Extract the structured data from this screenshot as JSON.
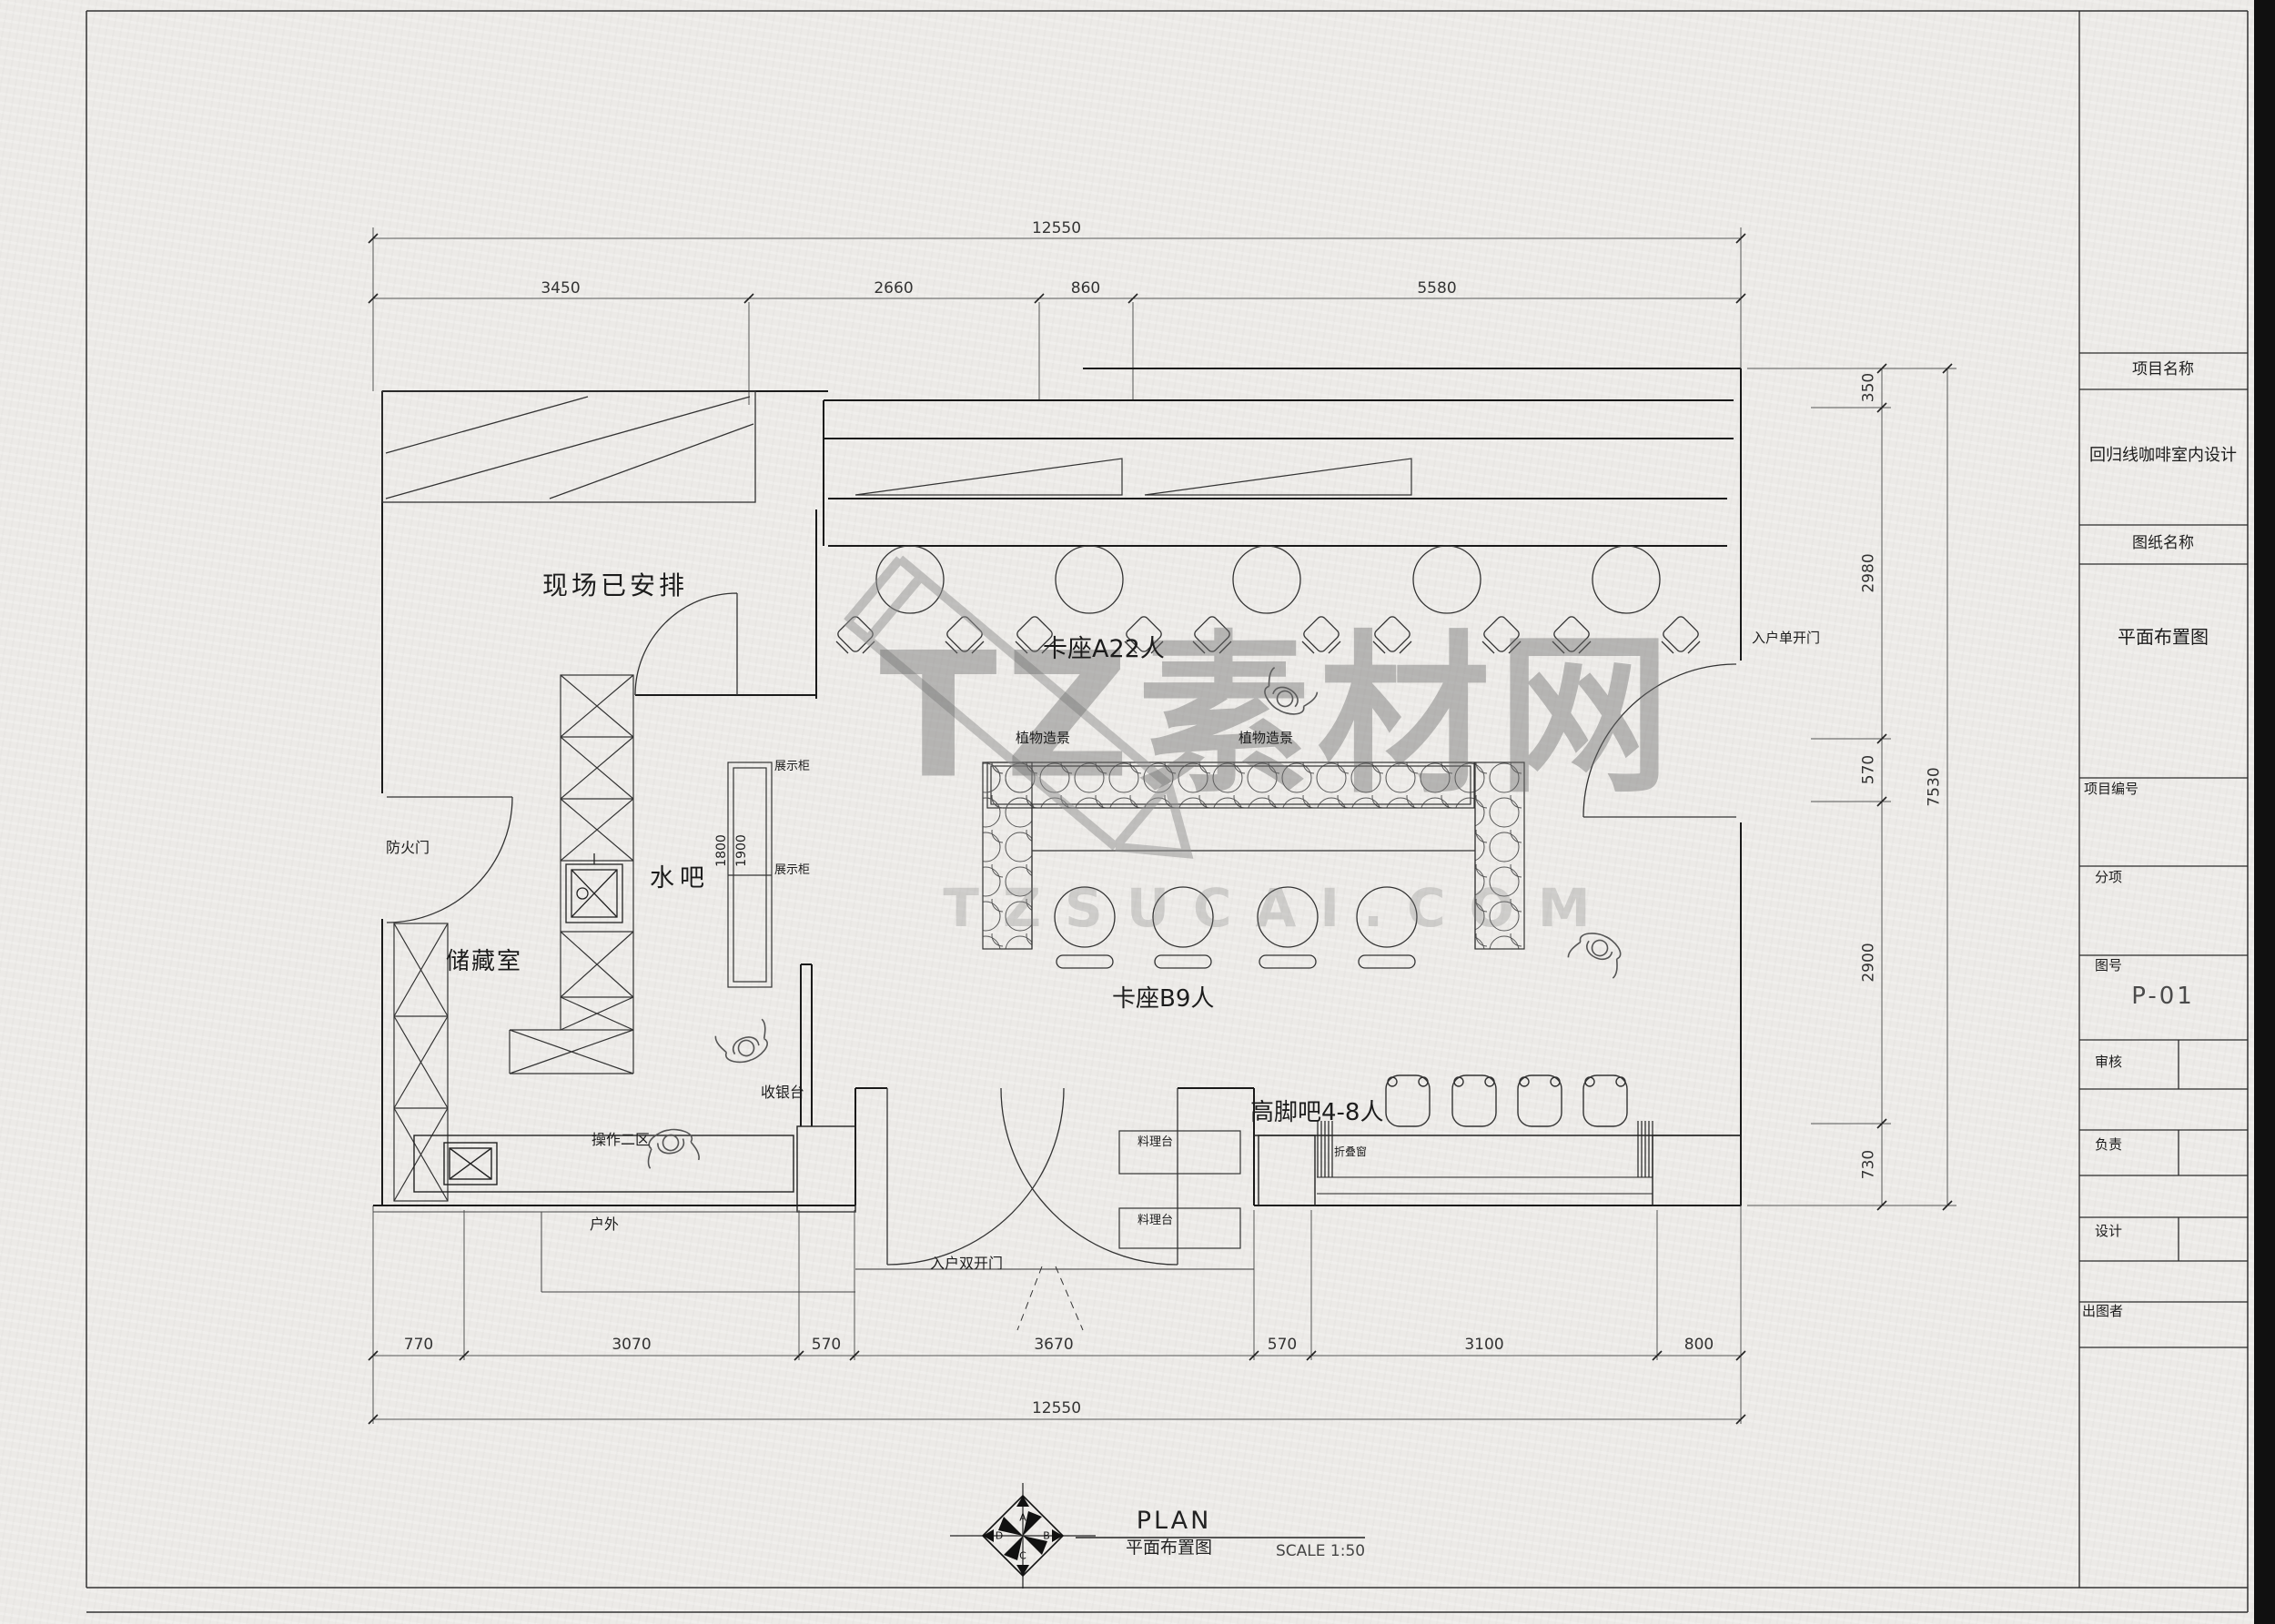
{
  "sheet": {
    "paper_color": "#eceae7",
    "line_color": "#222222",
    "edge_bar_color": "#101010"
  },
  "watermark": {
    "main_text": "TZ素材网",
    "sub_text": "TZSUCAI.COM",
    "color": "#8a8a8a"
  },
  "dimensions": {
    "top_total": "12550",
    "top_segments": [
      "3450",
      "2660",
      "860",
      "5580"
    ],
    "right_segments": [
      "350",
      "2980",
      "570",
      "2900",
      "730"
    ],
    "right_total": "7530",
    "bottom_segments": [
      "770",
      "3070",
      "570",
      "3670",
      "570",
      "3100",
      "800"
    ],
    "bottom_total": "12550",
    "cabinet_depth_a": "1800",
    "cabinet_depth_b": "1900"
  },
  "plan": {
    "site_arranged": "现场已安排",
    "booth_a": "卡座A22人",
    "booth_b": "卡座B9人",
    "high_bar": "高脚吧4-8人",
    "water_bar": "水吧",
    "storage": "储藏室",
    "fire_door": "防火门",
    "display_cabinet_1": "展示柜",
    "display_cabinet_2": "展示柜",
    "plant_scape_1": "植物造景",
    "plant_scape_2": "植物造景",
    "cashier": "收银台",
    "operation_zone_2": "操作二区",
    "outdoor": "户外",
    "entry_double_door": "入户双开门",
    "entry_single_door": "入户单开门",
    "folding_window": "折叠窗",
    "prep_counter_1": "料理台",
    "prep_counter_2": "料理台"
  },
  "title_block": {
    "project_name_label": "项目名称",
    "project_name_value": "回归线咖啡室内设计",
    "drawing_name_label": "图纸名称",
    "drawing_name_value": "平面布置图",
    "project_no_label": "项目编号",
    "sub_item_label": "分项",
    "drawing_no_label": "图号",
    "drawing_no_value": "P-01",
    "review_label": "审核",
    "responsible_label": "负责",
    "design_label": "设计",
    "issue_label": "出图者"
  },
  "footer": {
    "title": "PLAN",
    "subtitle": "平面布置图",
    "scale": "SCALE 1:50",
    "compass_n": "A",
    "compass_e": "B",
    "compass_s": "C",
    "compass_w": "D"
  }
}
